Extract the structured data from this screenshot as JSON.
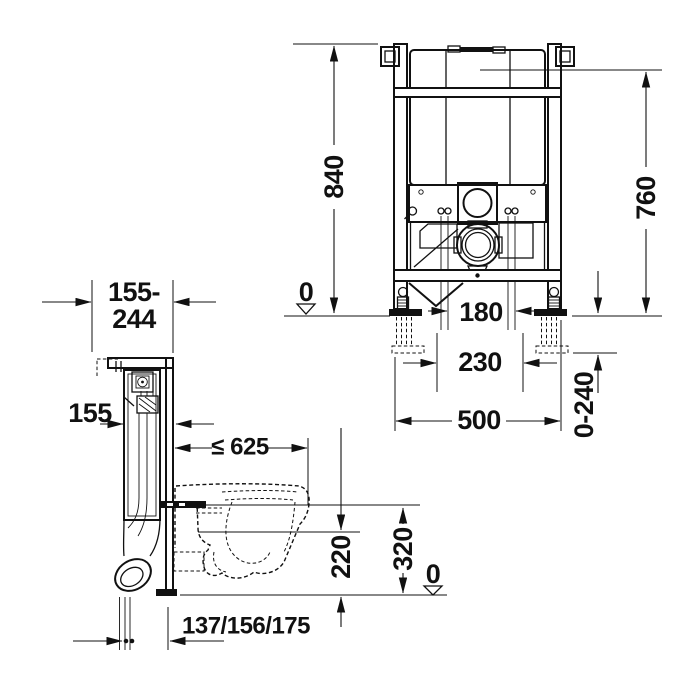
{
  "side_view": {
    "labels": {
      "wall_distance_line1": "155-",
      "wall_distance_line2": "244",
      "frame_depth": "155",
      "max_projection": "≤ 625",
      "height_320": "320",
      "height_220": "220",
      "floor_datum": "0",
      "drain_offsets": "137/156/175"
    }
  },
  "front_view": {
    "labels": {
      "frame_height": "840",
      "top_height": "760",
      "floor_datum": "0",
      "bolt_spacing": "180",
      "connection_spacing": "230",
      "frame_width": "500",
      "foot_adjustment": "0-240"
    }
  },
  "colors": {
    "line": "#111111",
    "background": "#ffffff"
  }
}
